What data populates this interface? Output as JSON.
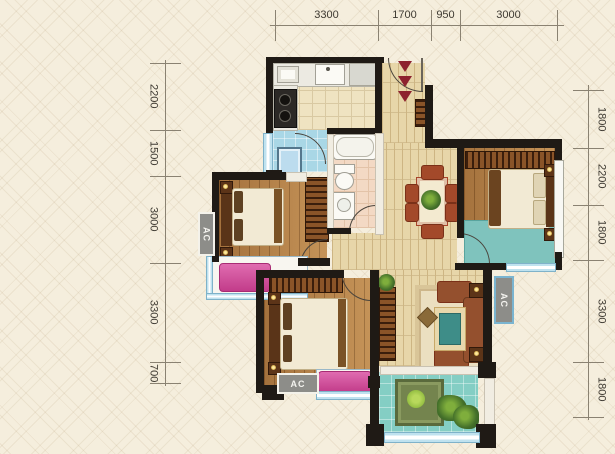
{
  "dims": {
    "top": [
      "3300",
      "1700",
      "950",
      "3000"
    ],
    "left": [
      "2200",
      "1500",
      "3000",
      "3300",
      "700"
    ],
    "right": [
      "1800",
      "2200",
      "1800",
      "3300",
      "1800"
    ]
  },
  "labels": {
    "ac": "AC"
  },
  "colors": {
    "bg": "#f5eedd",
    "wall": "#1f1a15",
    "dim_line": "#8a8272",
    "dim_text": "#3e3a32",
    "kitchen_floor": "#efe3c1",
    "tile_line": "#d9c9a2",
    "bath_floor": "#f3d9c4",
    "bath_line": "#e3c3a8",
    "utility_floor": "#a9d7e6",
    "hall_floor": "#e7d6a9",
    "plank_line": "#cdb583",
    "wood": "#bd894e",
    "wood_line": "#96632f",
    "wood_dark": "#5a3418",
    "teal": "#7fc3bd",
    "balcony": "#84cec4",
    "pink": "#d8569e",
    "counter": "#eceae2",
    "sofa": "#94502e",
    "chair": "#a3492a",
    "rug": "#ebdfc0",
    "rug_border": "#d9c598",
    "table_top": "#3e8d88",
    "accent_red": "#8d222e",
    "ac_bg": "#8d8d89",
    "ac_text": "#f4f3ef",
    "window_blue": "#bfe2ef",
    "window_frame": "#7fb2c9",
    "arc": "#4a443c"
  }
}
